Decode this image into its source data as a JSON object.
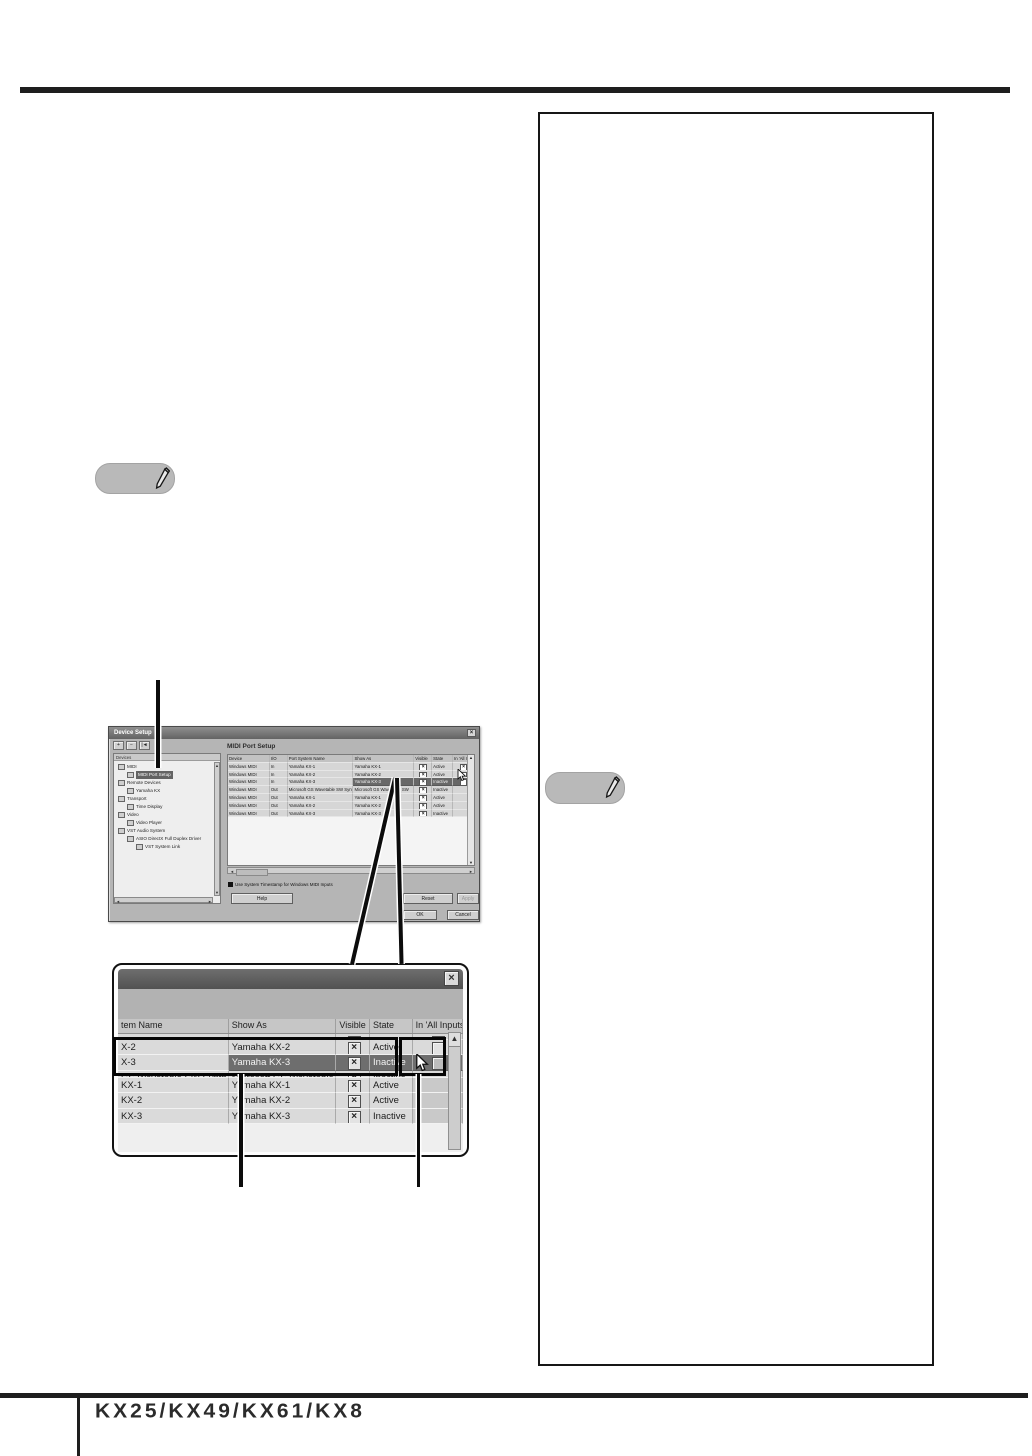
{
  "icons": {
    "note": "pencil-icon",
    "close": "×",
    "up": "▲",
    "down": "▼",
    "left": "◄",
    "right": "►",
    "checkbox_checked": "×",
    "cursor": "arrow-pointer"
  },
  "colors": {
    "rule": "#1e1e1e",
    "dialog_bg": "#b5b5b5",
    "selected_row": "#6e6e6e",
    "note_bg": "#b9b9b9"
  },
  "dialog1": {
    "title": "Device Setup",
    "toolbar": [
      "+",
      "−",
      "|◄"
    ],
    "devices_panel": {
      "header": "Devices",
      "tree": [
        {
          "label": "MIDI",
          "depth": 0
        },
        {
          "label": "MIDI Port Setup",
          "depth": 1,
          "selected": true
        },
        {
          "label": "Remote Devices",
          "depth": 0
        },
        {
          "label": "Yamaha KX",
          "depth": 1
        },
        {
          "label": "Transport",
          "depth": 0
        },
        {
          "label": "Time Display",
          "depth": 1
        },
        {
          "label": "Video",
          "depth": 0
        },
        {
          "label": "Video Player",
          "depth": 1
        },
        {
          "label": "VST Audio System",
          "depth": 0
        },
        {
          "label": "ASIO DirectX Full Duplex Driver",
          "depth": 1
        },
        {
          "label": "VST System Link",
          "depth": 2
        }
      ]
    },
    "main": {
      "heading": "MIDI Port Setup",
      "columns": [
        "Device",
        "I/O",
        "Port System Name",
        "Show As",
        "Visible",
        "State",
        "In 'All Inputs'"
      ],
      "rows": [
        {
          "device": "Windows MIDI",
          "io": "In",
          "port": "Yamaha KX-1",
          "show": "Yamaha KX-1",
          "visible": true,
          "state": "Active",
          "all": "checked"
        },
        {
          "device": "Windows MIDI",
          "io": "In",
          "port": "Yamaha KX-2",
          "show": "Yamaha KX-2",
          "visible": true,
          "state": "Active",
          "all": "empty"
        },
        {
          "device": "Windows MIDI",
          "io": "In",
          "port": "Yamaha KX-3",
          "show": "Yamaha KX-3",
          "visible": true,
          "state": "Inactive",
          "all": "empty",
          "selected": true,
          "cursor": true
        },
        {
          "device": "Windows MIDI",
          "io": "Out",
          "port": "Microsoft GS Wavetable SW Synth",
          "show": "Microsoft GS Wavetable SW",
          "visible": true,
          "state": "Inactive",
          "all": "none"
        },
        {
          "device": "Windows MIDI",
          "io": "Out",
          "port": "Yamaha KX-1",
          "show": "Yamaha KX-1",
          "visible": true,
          "state": "Active",
          "all": "none"
        },
        {
          "device": "Windows MIDI",
          "io": "Out",
          "port": "Yamaha KX-2",
          "show": "Yamaha KX-2",
          "visible": true,
          "state": "Active",
          "all": "none"
        },
        {
          "device": "Windows MIDI",
          "io": "Out",
          "port": "Yamaha KX-3",
          "show": "Yamaha KX-3",
          "visible": true,
          "state": "Inactive",
          "all": "none"
        }
      ],
      "timestamp_label": "Use System Timestamp for Windows MIDI Inputs",
      "buttons": {
        "help": "Help",
        "reset": "Reset",
        "apply": "Apply",
        "ok": "OK",
        "cancel": "Cancel"
      }
    }
  },
  "dialog2": {
    "columns": [
      "tem Name",
      "Show As",
      "Visible",
      "State",
      "In 'All Inputs'"
    ],
    "rows": [
      {
        "name": "KX-1",
        "show": "Yamaha KX-1",
        "visible": true,
        "state": "Active",
        "all": "checked",
        "partial": "top"
      },
      {
        "name": "X-2",
        "show": "Yamaha KX-2",
        "visible": true,
        "state": "Active",
        "all": "empty"
      },
      {
        "name": "X-3",
        "show": "Yamaha KX-3",
        "visible": true,
        "state": "Inactive",
        "all": "empty",
        "selected": true,
        "cursor": true
      },
      {
        "name": "GS Wavetable SW Synth",
        "show": "Microsoft GS Wavetable SW",
        "visible": true,
        "state": "Inactive",
        "all": "none",
        "partial": "bottom"
      },
      {
        "name": "KX-1",
        "show": "Yamaha KX-1",
        "visible": true,
        "state": "Active",
        "all": "shade"
      },
      {
        "name": "KX-2",
        "show": "Yamaha KX-2",
        "visible": true,
        "state": "Active",
        "all": "shade"
      },
      {
        "name": "KX-3",
        "show": "Yamaha KX-3",
        "visible": true,
        "state": "Inactive",
        "all": "shade"
      }
    ]
  },
  "footer": {
    "logo": "KX25/KX49/KX61/KX8"
  }
}
